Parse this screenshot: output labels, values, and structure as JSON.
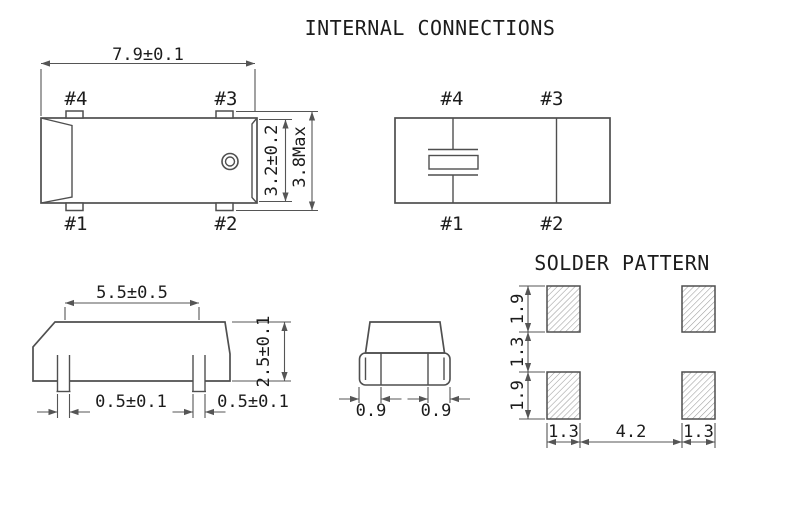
{
  "titles": {
    "internal_connections": "INTERNAL CONNECTIONS",
    "solder_pattern": "SOLDER PATTERN"
  },
  "colors": {
    "background": "#ffffff",
    "line": "#4f4f4f",
    "text": "#1c1c1c",
    "hatch": "#9b9b9b"
  },
  "top_view": {
    "pin_labels": {
      "p1": "#1",
      "p2": "#2",
      "p3": "#3",
      "p4": "#4"
    },
    "dims": {
      "length": "7.9±0.1",
      "body_width": "3.2±0.2",
      "overall_width": "3.8Max"
    }
  },
  "internal_connections": {
    "pin_labels": {
      "p1": "#1",
      "p2": "#2",
      "p3": "#3",
      "p4": "#4"
    }
  },
  "side_view": {
    "dims": {
      "lead_spacing": "5.5±0.5",
      "body_height": "2.5±0.1",
      "lead_width_left": "0.5±0.1",
      "lead_width_right": "0.5±0.1"
    }
  },
  "end_view": {
    "dims": {
      "lead_left": "0.9",
      "lead_right": "0.9"
    }
  },
  "solder_pattern": {
    "dims": {
      "pad_height_top": "1.9",
      "row_gap": "1.3",
      "pad_height_bottom": "1.9",
      "pad_width_left": "1.3",
      "column_gap": "4.2",
      "pad_width_right": "1.3"
    }
  }
}
